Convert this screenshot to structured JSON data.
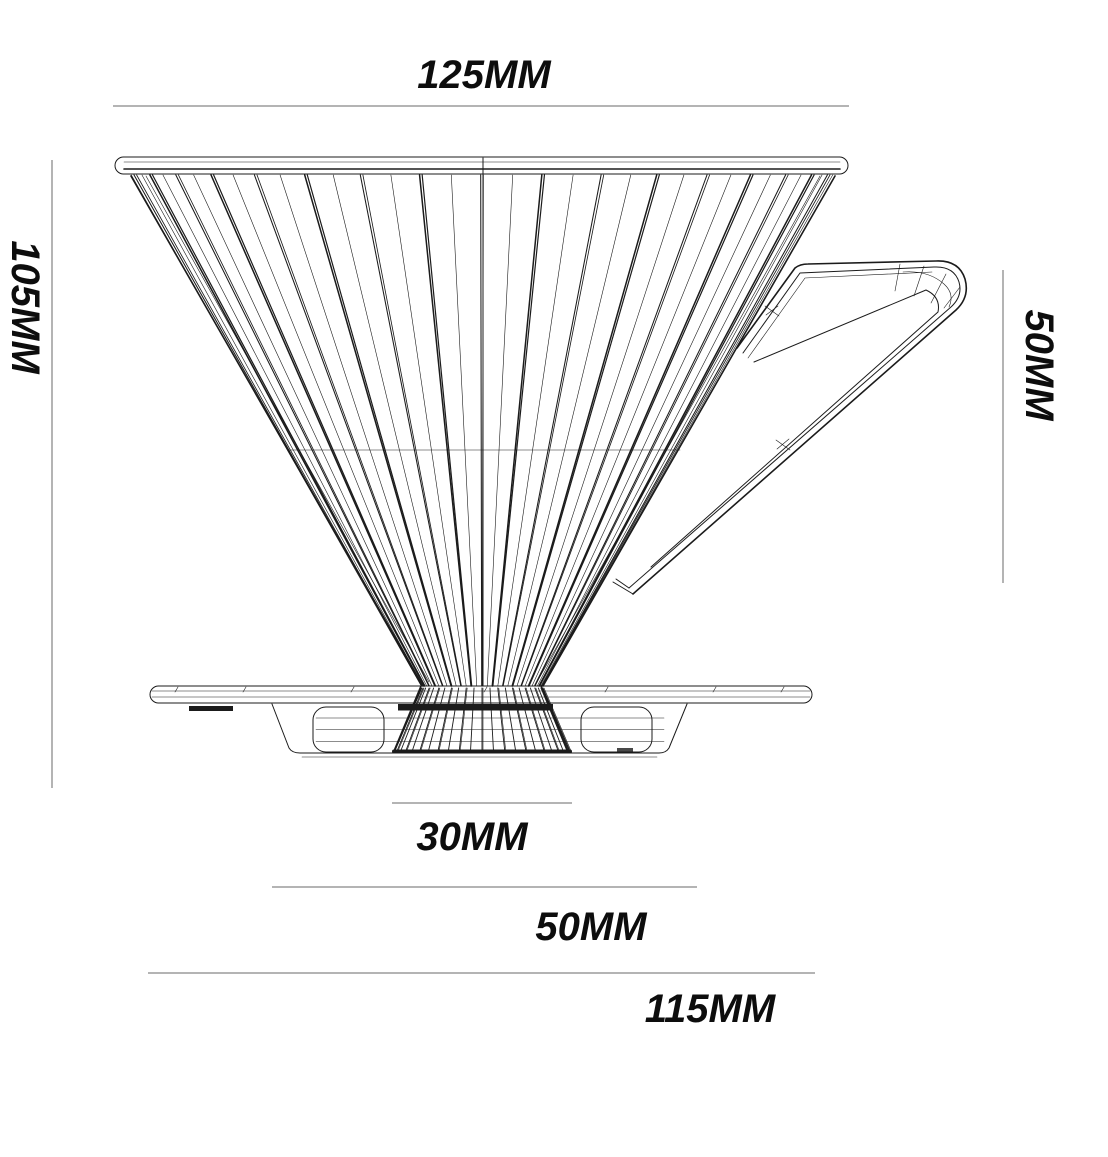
{
  "drawing": {
    "subject": "pour-over coffee dripper side-view technical drawing",
    "units": "MM"
  },
  "dimensions": {
    "top_width": {
      "label": "125MM",
      "value_mm": 125
    },
    "total_height": {
      "label": "105MM",
      "value_mm": 105
    },
    "handle_height": {
      "label": "50MM",
      "value_mm": 50
    },
    "base_inner_width": {
      "label": "30MM",
      "value_mm": 30
    },
    "base_mid_width": {
      "label": "50MM",
      "value_mm": 50
    },
    "base_outer_width": {
      "label": "115MM",
      "value_mm": 115
    }
  },
  "colors": {
    "background": "#ffffff",
    "ink": "#1b1b1b",
    "dimension_line": "#9c9c9c",
    "label_text": "#0d0d0d"
  }
}
